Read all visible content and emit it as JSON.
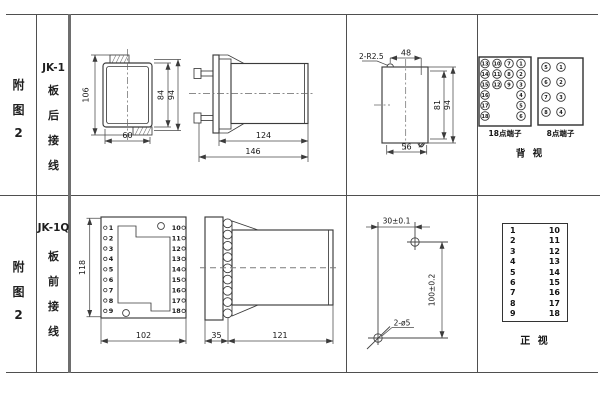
{
  "palette": {
    "background": "#ffffff",
    "line": "#3b3b3b",
    "dim_line": "#4a4a4a",
    "text": "#161616",
    "border": "#4f4f4f"
  },
  "top_row": {
    "figure": "附图2",
    "model": "JK-1",
    "wiring": "板后接线",
    "rear_view": {
      "overall_height": "106",
      "inner_height": "84",
      "outer_height": "94",
      "width": "60"
    },
    "side_view": {
      "body_depth": "124",
      "overall_depth": "146"
    },
    "cutout_view": {
      "corner_note": "2-R2.5",
      "top_width": "48",
      "inner_height": "81",
      "outer_height": "94",
      "bottom_width": "56"
    },
    "back_view": {
      "t18_label": "18点端子",
      "t8_label": "8点端子",
      "view_label": "背 视",
      "t18": {
        "c1": [
          "13",
          "14",
          "15",
          "16",
          "17",
          "18"
        ],
        "c2": [
          "10",
          "11",
          "12"
        ],
        "c3": [
          "7",
          "8",
          "9"
        ],
        "c4": [
          "1",
          "2",
          "3",
          "4",
          "5",
          "6"
        ]
      },
      "t8": {
        "c1": [
          "5",
          "6",
          "7",
          "8"
        ],
        "c2": [
          "1",
          "2",
          "3",
          "4"
        ]
      }
    }
  },
  "bottom_row": {
    "figure": "附图2",
    "model": "JK-1Q",
    "wiring": "板前接线",
    "front_view": {
      "height": "118",
      "width": "102"
    },
    "terminals": {
      "left": [
        "1",
        "2",
        "3",
        "4",
        "5",
        "6",
        "7",
        "8",
        "9"
      ],
      "right": [
        "10",
        "11",
        "12",
        "13",
        "14",
        "15",
        "16",
        "17",
        "18"
      ]
    },
    "side_view": {
      "flange_depth": "35",
      "body_depth": "121"
    },
    "drill_view": {
      "h_dist": "30±0.1",
      "v_dist": "100±0.2",
      "hole_note": "2-ø5"
    },
    "front_table_label": "正 视"
  }
}
